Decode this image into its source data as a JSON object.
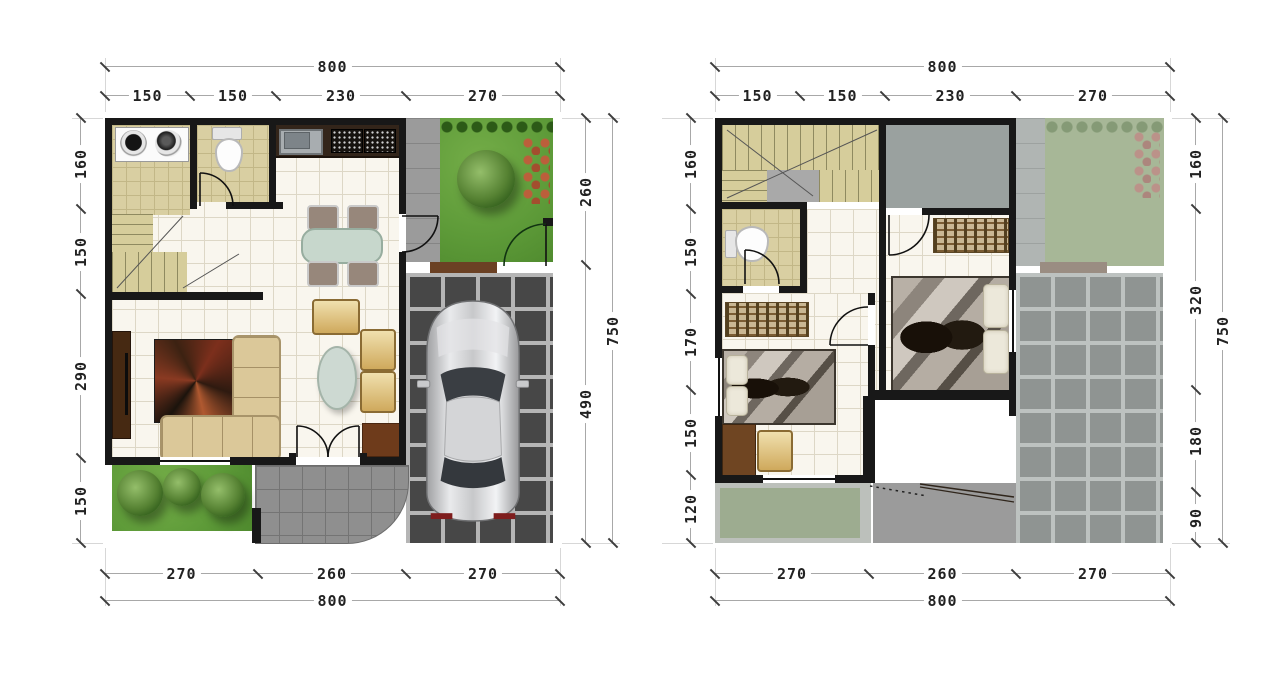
{
  "palette": {
    "wall": "#181818",
    "dim_line": "#a8a8a8",
    "dim_text": "#222222",
    "floor_tile": "#f9f6ee",
    "wet_room_tile": "#d9cfa2",
    "stair": "#d6cd9b",
    "garden_green": "#5d9a38",
    "garden_green_upper": "#a7b797",
    "carport_dark": "#474747",
    "carport_upper": "#8f9492",
    "paving_gray": "#8f8f8f",
    "roof_gray": "#9aa19f",
    "car_body": "#cfd0d2",
    "sofa_tan": "#dbc899",
    "counter_brown": "#33251a"
  },
  "plans": {
    "ground": {
      "top_total": "800",
      "top_segments": [
        "150",
        "150",
        "230",
        "270"
      ],
      "left_segments": [
        "160",
        "150",
        "290",
        "150"
      ],
      "right_segments": [
        "260",
        "490"
      ],
      "right_total": "750",
      "bottom_segments": [
        "270",
        "260",
        "270"
      ],
      "bottom_total": "800"
    },
    "upper": {
      "top_total": "800",
      "top_segments": [
        "150",
        "150",
        "230",
        "270"
      ],
      "left_segments": [
        "160",
        "150",
        "170",
        "150",
        "120"
      ],
      "right_segments": [
        "160",
        "320",
        "180",
        "90"
      ],
      "right_total": "750",
      "bottom_segments": [
        "270",
        "260",
        "270"
      ],
      "bottom_total": "800"
    }
  }
}
